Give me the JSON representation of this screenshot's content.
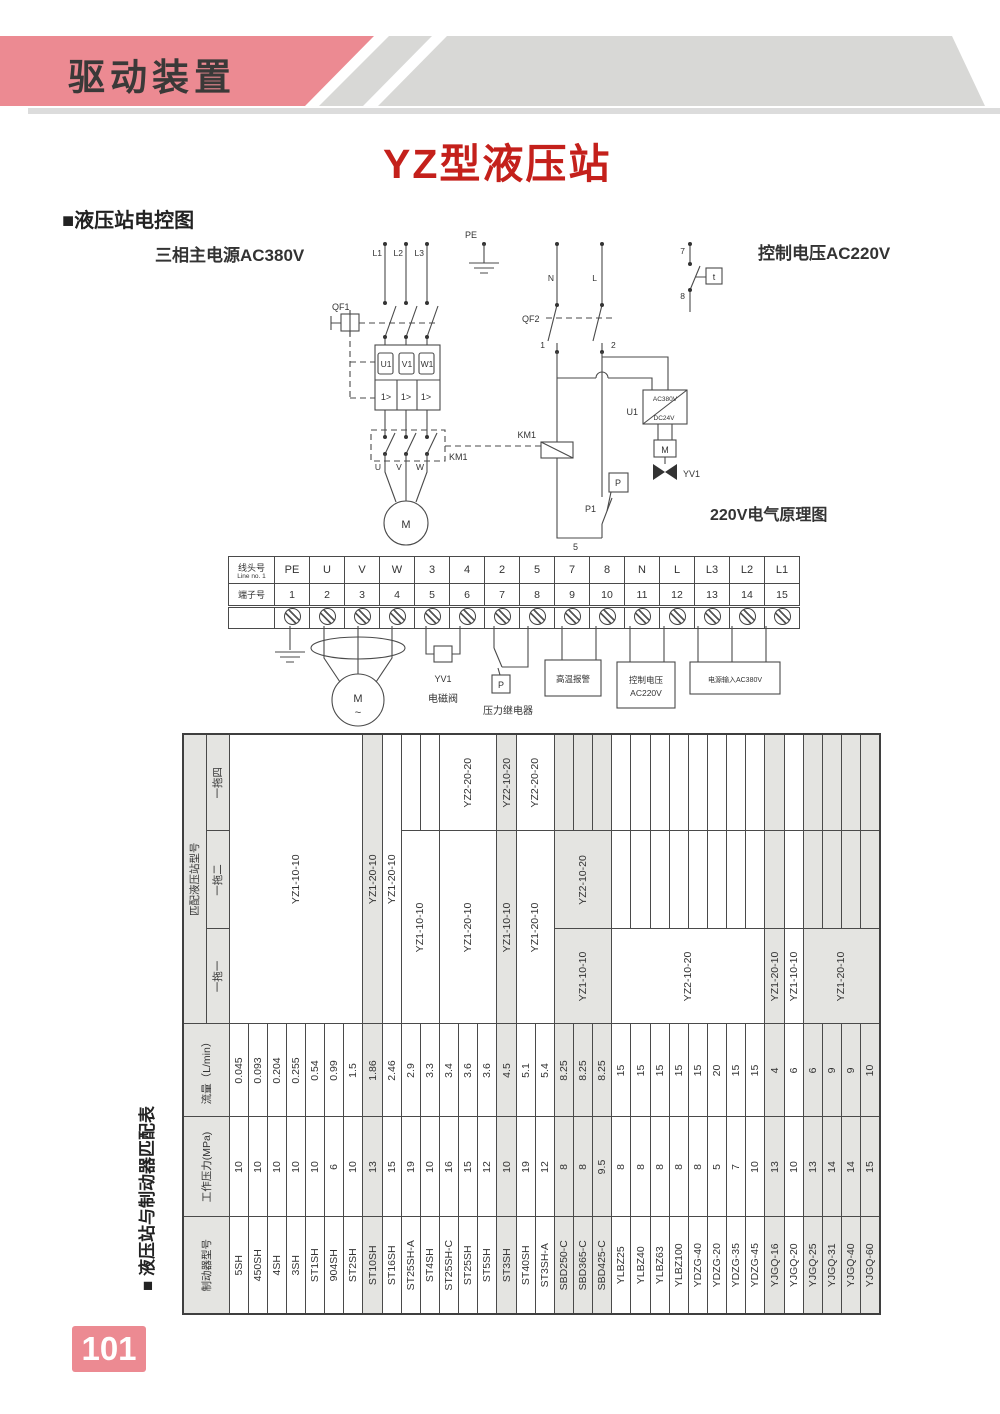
{
  "page": {
    "banner_title": "驱动装置",
    "title": "YZ型液压站",
    "page_number": "101",
    "colors": {
      "pink": "#ec8a92",
      "title_red": "#c4201b",
      "band_gray": "#d8d8d6",
      "table_gray": "#e4e4e1"
    }
  },
  "electric_section": {
    "heading": "■液压站电控图",
    "label_main_power": "三相主电源AC380V",
    "label_control_voltage": "控制电压AC220V",
    "label_principle": "220V电气原理图",
    "circuit": {
      "pe": "PE",
      "l1": "L1",
      "l2": "L2",
      "l3": "L3",
      "qf1": "QF1",
      "u1v1w1": [
        "U1",
        "V1",
        "W1"
      ],
      "overload": "1>",
      "km1_contacts": "KM1",
      "uvw": [
        "U",
        "V",
        "W"
      ],
      "motor": "M",
      "n": "N",
      "l": "L",
      "qf2": "QF2",
      "node1": "1",
      "node2": "2",
      "km1_coil": "KM1",
      "node5": "5",
      "p1": "P1",
      "p": "P",
      "u1": "U1",
      "ac380": "AC380V",
      "dc24": "DC24V",
      "m_box": "M",
      "yv1": "YV1",
      "c7": "7",
      "c8": "8",
      "t": "t"
    }
  },
  "terminal_strip": {
    "row1_label": "线头号",
    "row1_sublabel": "Line no. 1",
    "row2_label": "端子号",
    "line_numbers": [
      "PE",
      "U",
      "V",
      "W",
      "3",
      "4",
      "2",
      "5",
      "7",
      "8",
      "N",
      "L",
      "L3",
      "L2",
      "L1"
    ],
    "terminal_numbers": [
      "1",
      "2",
      "3",
      "4",
      "5",
      "6",
      "7",
      "8",
      "9",
      "10",
      "11",
      "12",
      "13",
      "14",
      "15"
    ]
  },
  "annotations": {
    "yv1": "YV1",
    "solenoid_valve": "电磁阀",
    "p": "P",
    "pressure_relay": "压力继电器",
    "high_temp_alarm": "高温报警",
    "control_voltage_line1": "控制电压",
    "control_voltage_line2": "AC220V",
    "power_input": "电源输入AC380V",
    "motor": "M",
    "motor_tilde": "~"
  },
  "match_table": {
    "section_label": "■ 液压站与制动器匹配表",
    "headers": {
      "model": "制动器型号",
      "pressure": "工作压力(MPa)",
      "flow": "流量（L/min）",
      "station_group": "匹配液压站型号",
      "one_one": "一拖一",
      "one_two": "一拖二",
      "one_four": "一拖四"
    },
    "rows": [
      {
        "model": "5SH",
        "pressure": "10",
        "flow": "0.045",
        "gray": false
      },
      {
        "model": "450SH",
        "pressure": "10",
        "flow": "0.093",
        "gray": false
      },
      {
        "model": "4SH",
        "pressure": "10",
        "flow": "0.204",
        "gray": false
      },
      {
        "model": "3SH",
        "pressure": "10",
        "flow": "0.255",
        "gray": false
      },
      {
        "model": "ST1SH",
        "pressure": "10",
        "flow": "0.54",
        "gray": false
      },
      {
        "model": "904SH",
        "pressure": "6",
        "flow": "0.99",
        "gray": false
      },
      {
        "model": "ST2SH",
        "pressure": "10",
        "flow": "1.5",
        "gray": false
      },
      {
        "model": "ST10SH",
        "pressure": "13",
        "flow": "1.86",
        "gray": true
      },
      {
        "model": "ST16SH",
        "pressure": "15",
        "flow": "2.46",
        "gray": false
      },
      {
        "model": "ST25SH-A",
        "pressure": "19",
        "flow": "2.9",
        "gray": false
      },
      {
        "model": "ST4SH",
        "pressure": "10",
        "flow": "3.3",
        "gray": false
      },
      {
        "model": "ST25SH-C",
        "pressure": "16",
        "flow": "3.4",
        "gray": false
      },
      {
        "model": "ST25SH",
        "pressure": "15",
        "flow": "3.6",
        "gray": false
      },
      {
        "model": "ST5SH",
        "pressure": "12",
        "flow": "3.6",
        "gray": false
      },
      {
        "model": "ST3SH",
        "pressure": "10",
        "flow": "4.5",
        "gray": true
      },
      {
        "model": "ST40SH",
        "pressure": "19",
        "flow": "5.1",
        "gray": false
      },
      {
        "model": "ST3SH-A",
        "pressure": "12",
        "flow": "5.4",
        "gray": false
      },
      {
        "model": "SBD250-C",
        "pressure": "8",
        "flow": "8.25",
        "gray": true
      },
      {
        "model": "SBD365-C",
        "pressure": "8",
        "flow": "8.25",
        "gray": true
      },
      {
        "model": "SBD425-C",
        "pressure": "9.5",
        "flow": "8.25",
        "gray": true
      },
      {
        "model": "YLBZ25",
        "pressure": "8",
        "flow": "15",
        "gray": false
      },
      {
        "model": "YLBZ40",
        "pressure": "8",
        "flow": "15",
        "gray": false
      },
      {
        "model": "YLBZ63",
        "pressure": "8",
        "flow": "15",
        "gray": false
      },
      {
        "model": "YLBZ100",
        "pressure": "8",
        "flow": "15",
        "gray": false
      },
      {
        "model": "YDZG-40",
        "pressure": "8",
        "flow": "15",
        "gray": false
      },
      {
        "model": "YDZG-20",
        "pressure": "5",
        "flow": "20",
        "gray": false
      },
      {
        "model": "YDZG-35",
        "pressure": "7",
        "flow": "15",
        "gray": false
      },
      {
        "model": "YDZG-45",
        "pressure": "10",
        "flow": "15",
        "gray": false
      },
      {
        "model": "YJGQ-16",
        "pressure": "13",
        "flow": "4",
        "gray": true
      },
      {
        "model": "YJGQ-20",
        "pressure": "10",
        "flow": "6",
        "gray": false
      },
      {
        "model": "YJGQ-25",
        "pressure": "13",
        "flow": "6",
        "gray": true
      },
      {
        "model": "YJGQ-31",
        "pressure": "14",
        "flow": "9",
        "gray": true
      },
      {
        "model": "YJGQ-40",
        "pressure": "14",
        "flow": "9",
        "gray": true
      },
      {
        "model": "YJGQ-60",
        "pressure": "15",
        "flow": "10",
        "gray": true
      }
    ],
    "station_cells": [
      {
        "row": 0,
        "rowspan": 7,
        "col": 0,
        "colspan": 3,
        "label": "YZ1-10-10"
      },
      {
        "row": 7,
        "rowspan": 1,
        "col": 0,
        "colspan": 3,
        "label": "YZ1-20-10"
      },
      {
        "row": 8,
        "rowspan": 1,
        "col": 0,
        "colspan": 3,
        "label": "YZ1-20-10"
      },
      {
        "row": 9,
        "rowspan": 2,
        "col": 0,
        "colspan": 2,
        "label": "YZ1-10-10"
      },
      {
        "row": 11,
        "rowspan": 3,
        "col": 0,
        "colspan": 2,
        "label": "YZ1-20-10"
      },
      {
        "row": 11,
        "rowspan": 3,
        "col": 2,
        "colspan": 1,
        "label": "YZ2-20-20"
      },
      {
        "row": 14,
        "rowspan": 1,
        "col": 0,
        "colspan": 2,
        "label": "YZ1-10-10"
      },
      {
        "row": 14,
        "rowspan": 1,
        "col": 2,
        "colspan": 1,
        "label": "YZ2-10-20"
      },
      {
        "row": 15,
        "rowspan": 2,
        "col": 0,
        "colspan": 2,
        "label": "YZ1-20-10"
      },
      {
        "row": 15,
        "rowspan": 2,
        "col": 2,
        "colspan": 1,
        "label": "YZ2-20-20"
      },
      {
        "row": 17,
        "rowspan": 3,
        "col": 0,
        "colspan": 1,
        "label": "YZ1-10-10"
      },
      {
        "row": 17,
        "rowspan": 3,
        "col": 1,
        "colspan": 1,
        "label": "YZ2-10-20"
      },
      {
        "row": 20,
        "rowspan": 8,
        "col": 0,
        "colspan": 1,
        "label": "YZ2-10-20"
      },
      {
        "row": 28,
        "rowspan": 1,
        "col": 0,
        "colspan": 1,
        "label": "YZ1-20-10"
      },
      {
        "row": 29,
        "rowspan": 1,
        "col": 0,
        "colspan": 1,
        "label": "YZ1-10-10"
      },
      {
        "row": 30,
        "rowspan": 4,
        "col": 0,
        "colspan": 1,
        "label": "YZ1-20-10"
      }
    ]
  }
}
